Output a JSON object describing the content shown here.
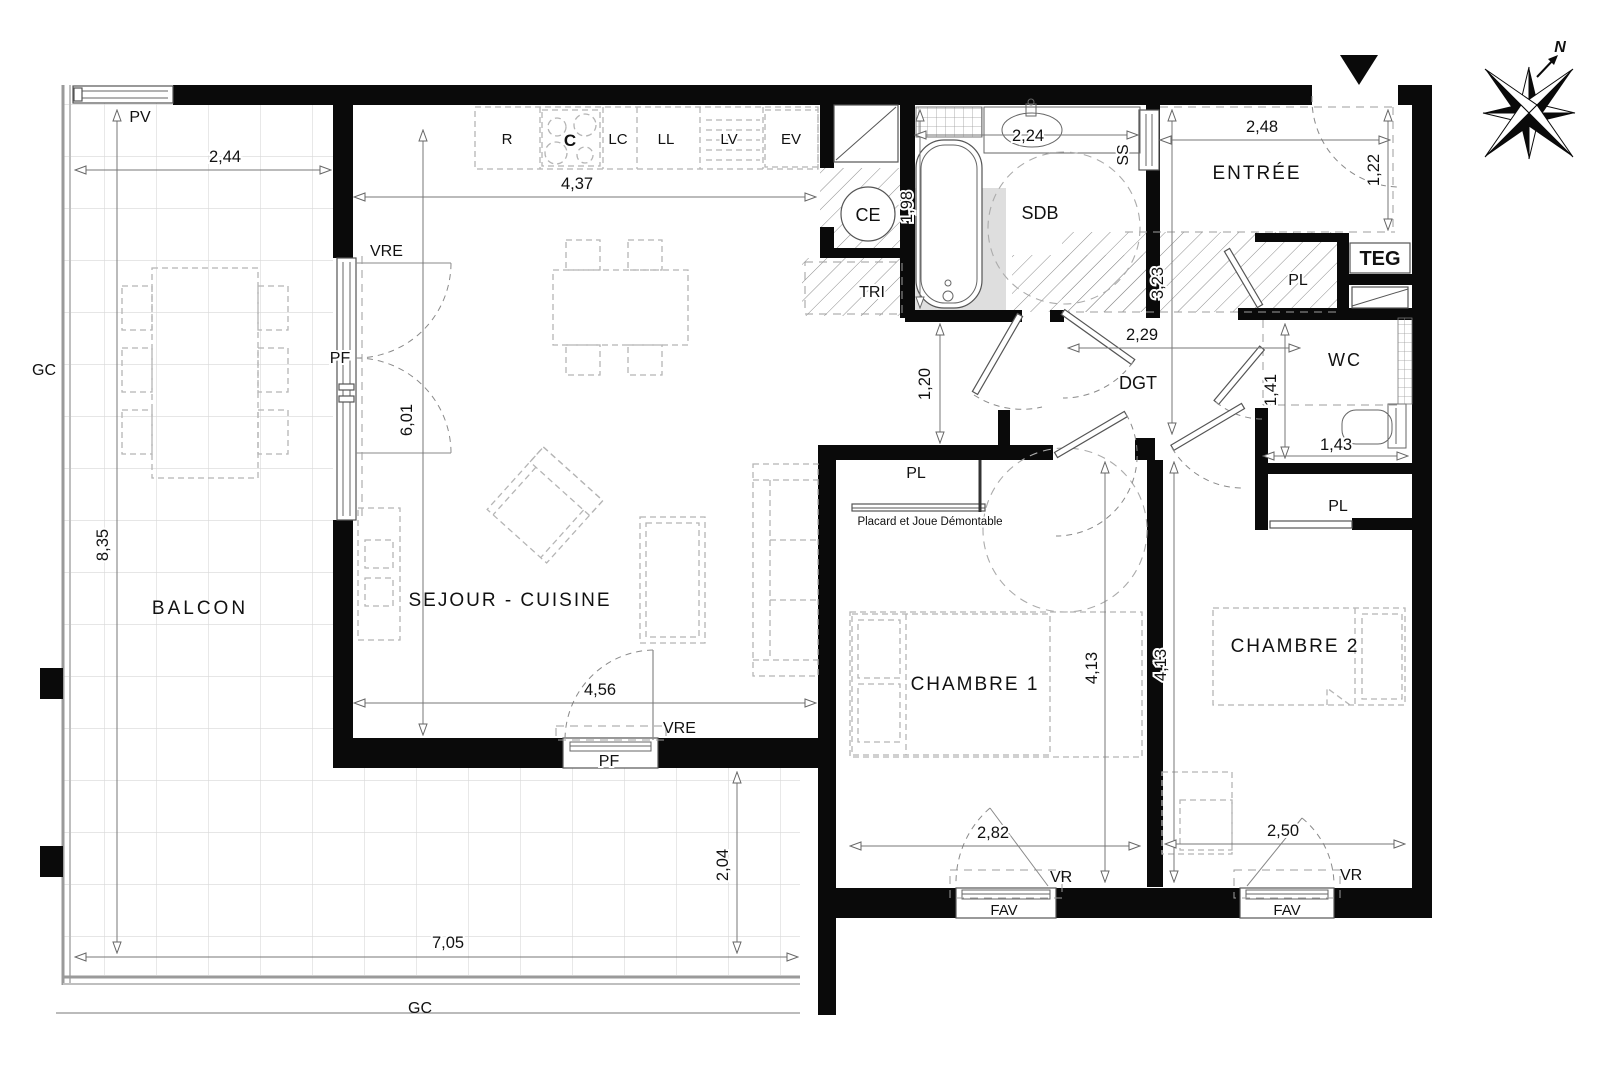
{
  "rooms": {
    "balcon": "BALCON",
    "sejour_cuisine": "SEJOUR - CUISINE",
    "chambre1": "CHAMBRE 1",
    "chambre2": "CHAMBRE 2",
    "entree": "ENTRÉE",
    "sdb": "SDB",
    "wc": "WC",
    "dgt": "DGT",
    "tri": "TRI",
    "ce": "CE",
    "teg": "TEG",
    "ss": "SS",
    "pl_entree": "PL",
    "pl_chambre1": "PL",
    "pl_chambre2": "PL"
  },
  "kitchen": {
    "r": "R",
    "c": "C",
    "lc": "LC",
    "ll": "LL",
    "lv": "LV",
    "ev": "EV"
  },
  "openings": {
    "pv": "PV",
    "gc_left": "GC",
    "gc_bottom": "GC",
    "vre_left": "VRE",
    "pf_left": "PF",
    "vre_bottom": "VRE",
    "pf_bottom": "PF",
    "vr_ch1": "VR",
    "vr_ch2": "VR",
    "fav_ch1": "FAV",
    "fav_ch2": "FAV"
  },
  "notes": {
    "placard": "Placard et Joue Démontable"
  },
  "compass": {
    "north": "N"
  },
  "dimensions": {
    "balcon_width": "2,44",
    "balcon_height": "8,35",
    "balcon_bottom_width": "7,05",
    "balcon_bottom_height": "2,04",
    "cuisine_width": "4,37",
    "sejour_width": "4,56",
    "sejour_height": "6,01",
    "baignoire": "1,98",
    "sdb_width": "2,24",
    "passage": "1,20",
    "entree_width": "2,48",
    "entree_depth": "1,22",
    "hall_depth": "3,23",
    "dgt_width": "2,29",
    "wc_depth": "1,41",
    "wc_width": "1,43",
    "ch1_width": "2,82",
    "ch1_depth": "4,13",
    "ch2_depth": "4,13",
    "ch2_width": "2,50"
  },
  "colors": {
    "wall": "#0a0a0a",
    "hatch": "#8c8c8c",
    "tile_grid": "#d8d8d8",
    "shower_shade": "#dedede",
    "furniture": "#b5b5b5"
  }
}
